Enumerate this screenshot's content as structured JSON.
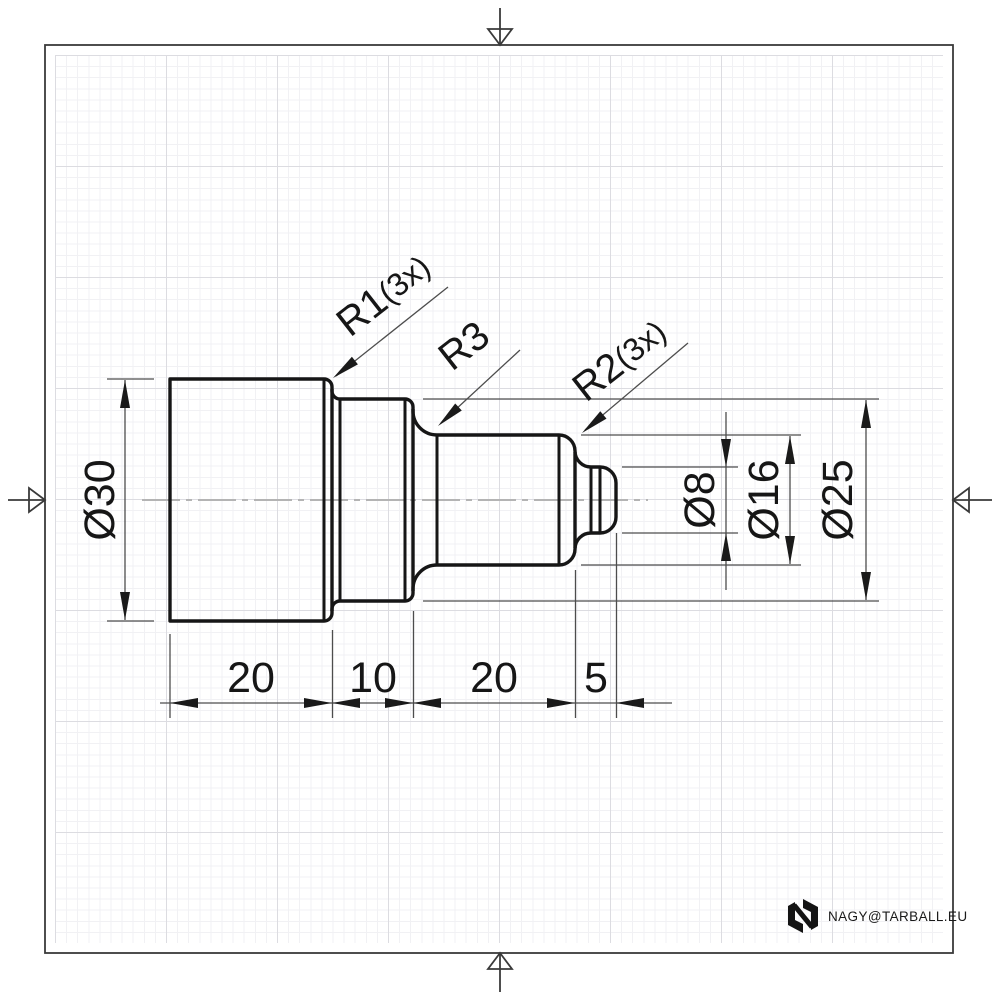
{
  "dimensions": {
    "diameter_30": "Ø30",
    "diameter_25": "Ø25",
    "diameter_16": "Ø16",
    "diameter_8": "Ø8",
    "length_20a": "20",
    "length_10": "10",
    "length_20b": "20",
    "length_5": "5"
  },
  "callouts": {
    "r1": {
      "label": "R1",
      "note": "(3x)"
    },
    "r3": {
      "label": "R3",
      "note": ""
    },
    "r2": {
      "label": "R2",
      "note": "(3x)"
    }
  },
  "branding": {
    "email": "NAGY@TARBALL.EU"
  },
  "icons": {
    "logo": "n-logomark-icon",
    "border_marks": [
      "center-mark-arrow-top",
      "center-mark-arrow-bottom",
      "center-mark-arrow-left",
      "center-mark-arrow-right"
    ]
  },
  "colors": {
    "paper": "#ffffff",
    "part_outline": "#161616",
    "thin_lines": "#4d4d4d",
    "centerline": "#b4b4b4",
    "grid_minor": "#f1f1f4",
    "grid_major": "#dcdce1",
    "border": "#3a3a3a"
  }
}
